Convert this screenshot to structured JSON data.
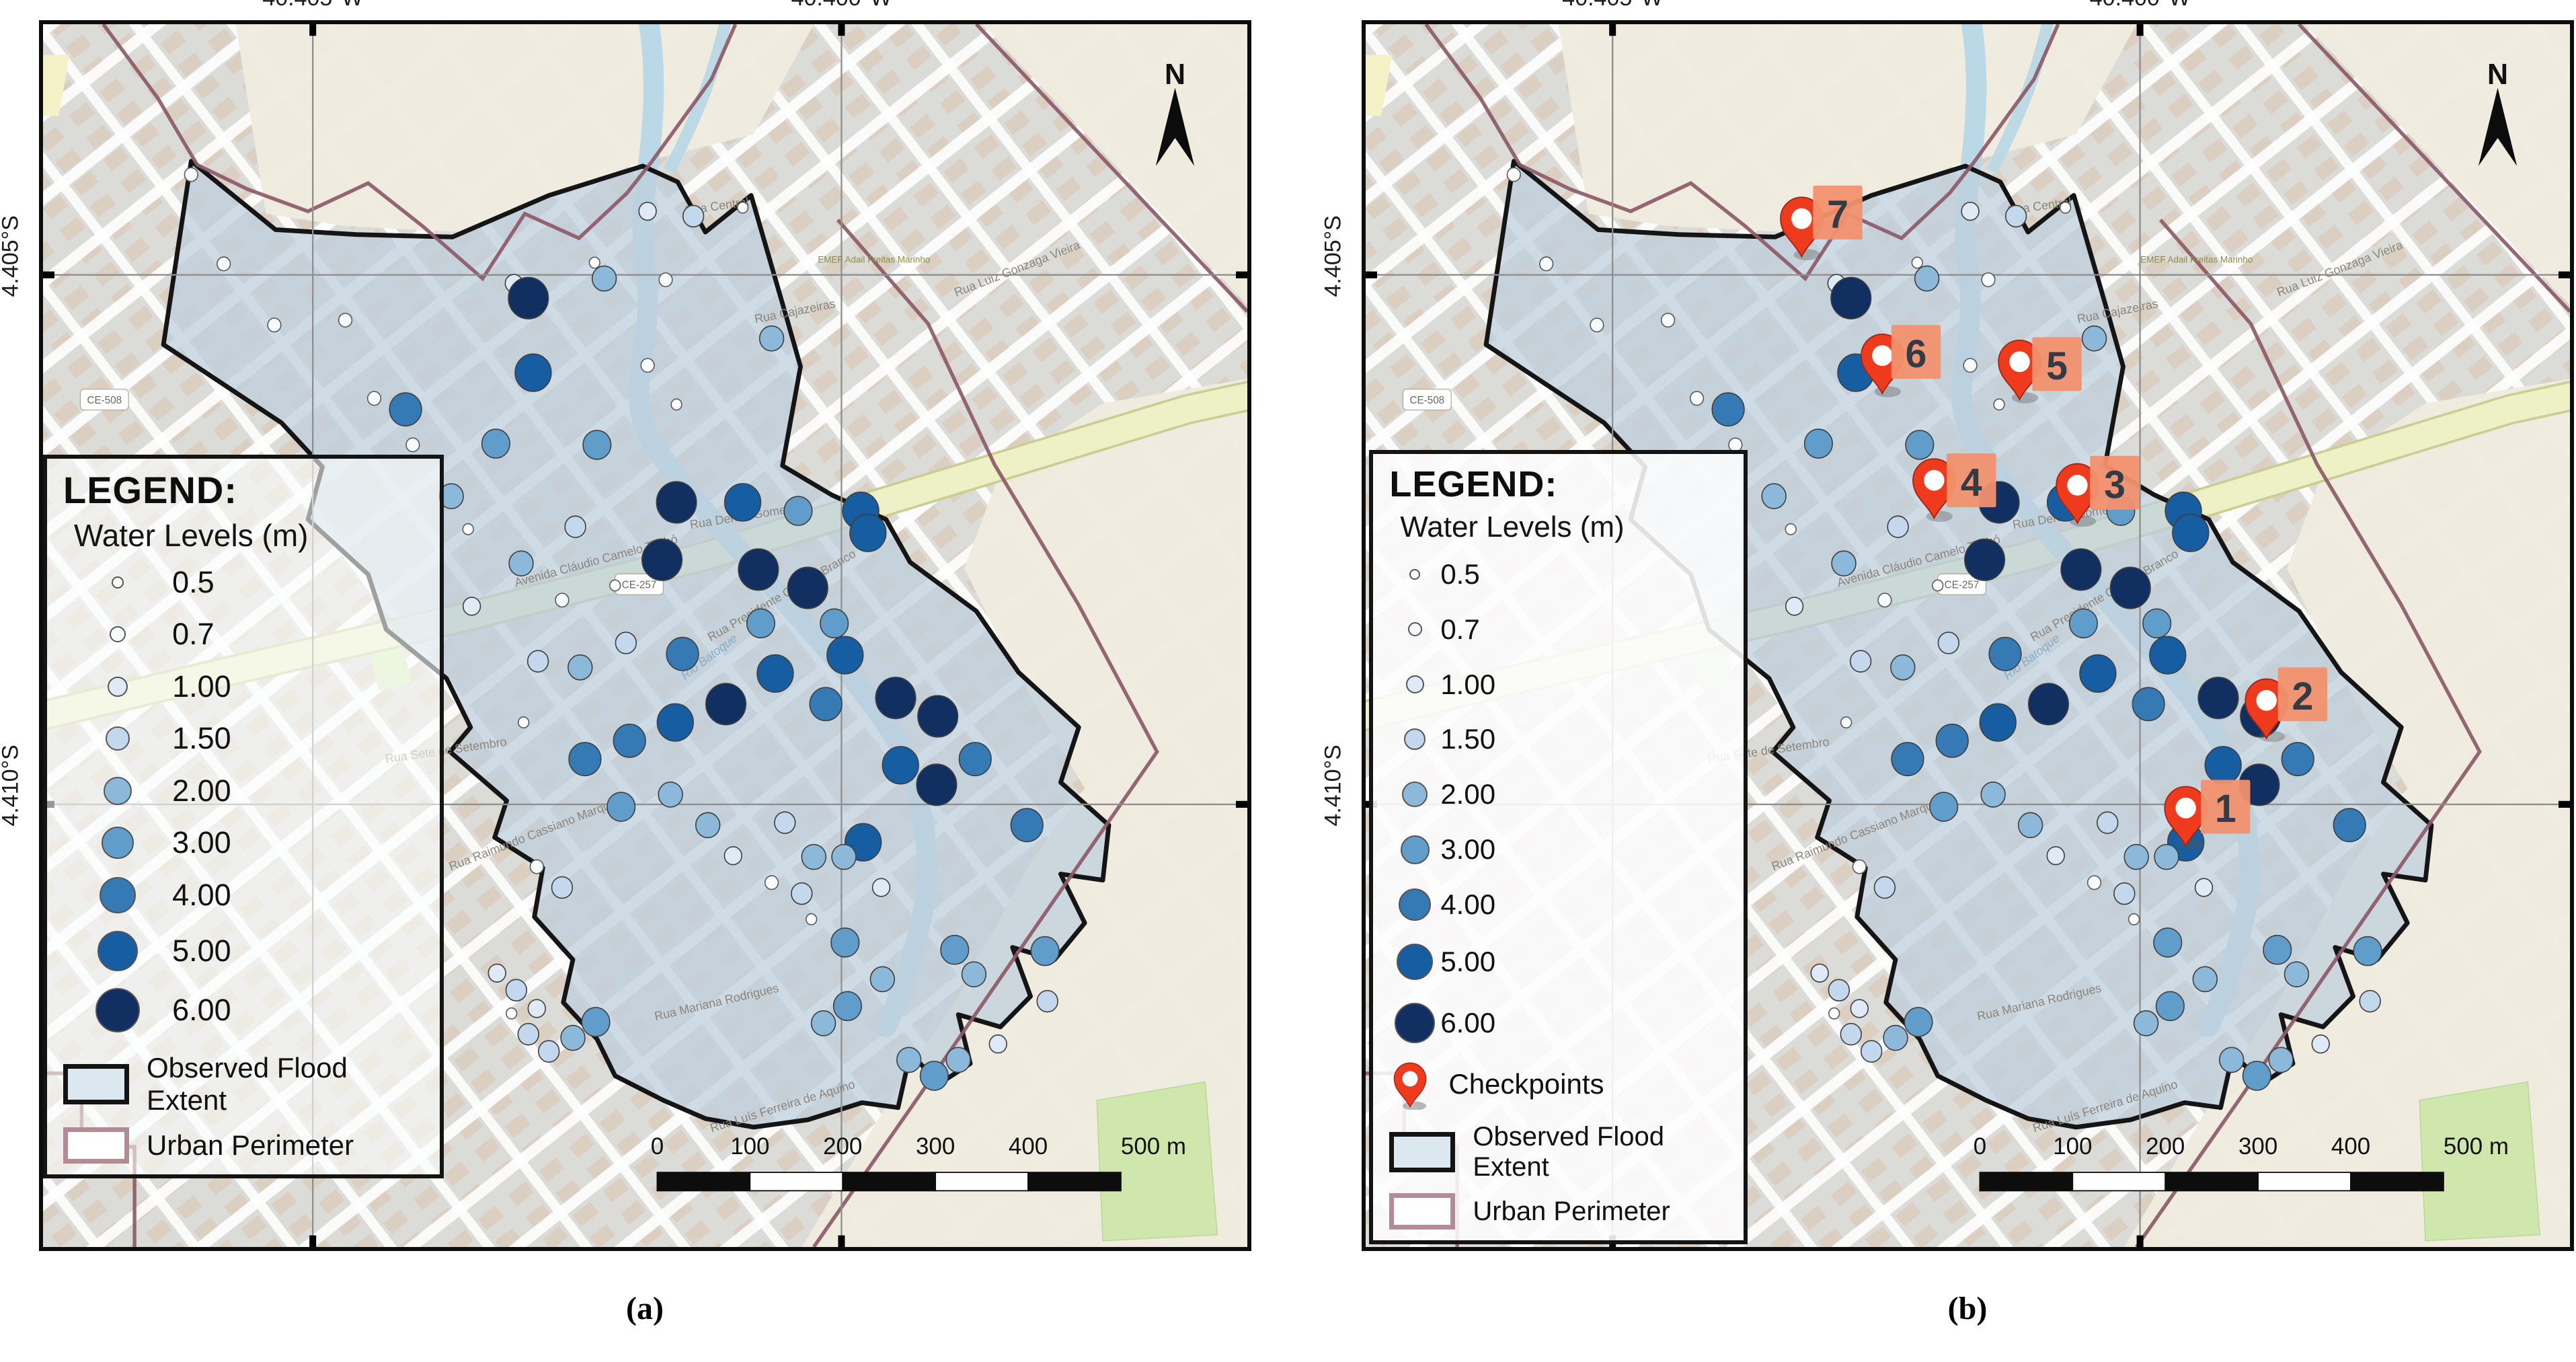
{
  "panels": {
    "a": {
      "caption": "(a)",
      "show_checkpoints": false,
      "legend_variant": "var-a",
      "grid_x_pct": [
        22.4,
        66.3
      ],
      "grid_y_pct": [
        20.5,
        63.8
      ],
      "axis_top": [
        "40.405°W",
        "40.400°W"
      ],
      "axis_left": [
        "4.405°S",
        "4.410°S"
      ]
    },
    "b": {
      "caption": "(b)",
      "show_checkpoints": true,
      "legend_variant": "var-b",
      "grid_x_pct": [
        20.5,
        64.3
      ],
      "grid_y_pct": [
        20.5,
        63.8
      ],
      "axis_top": [
        "40.405°W",
        "40.400°W"
      ],
      "axis_left": [
        "4.405°S",
        "4.410°S"
      ]
    }
  },
  "legend": {
    "title": "LEGEND:",
    "subtitle": "Water Levels (m)",
    "levels": [
      {
        "label": "0.5",
        "color": "#ffffff",
        "size_a": 18,
        "size_b": 16
      },
      {
        "label": "0.7",
        "color": "#f8fbfe",
        "size_a": 24,
        "size_b": 21
      },
      {
        "label": "1.00",
        "color": "#e0eaf6",
        "size_a": 30,
        "size_b": 27
      },
      {
        "label": "1.50",
        "color": "#c4d8ed",
        "size_a": 36,
        "size_b": 32
      },
      {
        "label": "2.00",
        "color": "#8cb9da",
        "size_a": 42,
        "size_b": 38
      },
      {
        "label": "3.00",
        "color": "#609dca",
        "size_a": 48,
        "size_b": 43
      },
      {
        "label": "4.00",
        "color": "#3579b5",
        "size_a": 54,
        "size_b": 48
      },
      {
        "label": "5.00",
        "color": "#175da1",
        "size_a": 60,
        "size_b": 54
      },
      {
        "label": "6.00",
        "color": "#112f60",
        "size_a": 66,
        "size_b": 60
      }
    ],
    "checkpoints_label": "Checkpoints",
    "flood_label": "Observed Flood Extent",
    "urban_label": "Urban Perimeter",
    "flood_swatch_color": "#dce8f0",
    "urban_swatch_border": "#b28b95"
  },
  "scalebar": {
    "labels": [
      "0",
      "100",
      "200",
      "300",
      "400",
      "500 m"
    ]
  },
  "north_label": "N",
  "map": {
    "colors": {
      "base": "#dbdbd8",
      "open_land": "#f0ebdf",
      "flood_fill": "#bccfdc",
      "flood_stroke": "#151515",
      "urban_perimeter": "#8d5a68",
      "river": "#b7d7e6",
      "avenue": "#eef0c6",
      "avenue_casing": "#cbcd92",
      "park": "#cfe7ad",
      "grid": "#8f8f8f",
      "pin_red": "#ee3b1e",
      "pin_stroke": "#a32410",
      "cp_label_bg": "#f2916e",
      "cp_label_text": "#333b44",
      "building": "#d9c7b2"
    },
    "shields": [
      {
        "text": "CE-508",
        "x": 5.1,
        "y": 30.7
      },
      {
        "text": "CE-257",
        "x": 49.5,
        "y": 45.8
      }
    ],
    "street_labels": [
      {
        "text": "Rua Central",
        "x": 56,
        "y": 15.2,
        "r": -8
      },
      {
        "text": "Rua Cajazeiras",
        "x": 62.5,
        "y": 23.8,
        "r": -11
      },
      {
        "text": "Rua Luiz Gonzaga Vieira",
        "x": 81,
        "y": 20.3,
        "r": -21
      },
      {
        "text": "Avenida Cláudio Camelo Timbó",
        "x": 46,
        "y": 44.2,
        "r": -15
      },
      {
        "text": "Rua Deniro Gomes",
        "x": 58,
        "y": 40.6,
        "r": -9
      },
      {
        "text": "Rua Presidente Castelo Branco",
        "x": 61.5,
        "y": 47,
        "r": -30
      },
      {
        "text": "Rio Batoque",
        "x": 55.5,
        "y": 52,
        "r": -37,
        "water": true
      },
      {
        "text": "Rua Sete de Setembro",
        "x": 33.5,
        "y": 59.7,
        "r": -8
      },
      {
        "text": "Rua Raimundo Cassiano Marques",
        "x": 41,
        "y": 66.5,
        "r": -21
      },
      {
        "text": "Rua Mariana Rodrigues",
        "x": 56,
        "y": 80.3,
        "r": -13
      },
      {
        "text": "Rua Luís Ferreira de Aquino",
        "x": 61.5,
        "y": 88.8,
        "r": -17
      },
      {
        "text": "EMEF Adail Freitas Marinho",
        "x": 69,
        "y": 19.5,
        "r": 0,
        "school": true
      }
    ],
    "water_level_values": [
      0.5,
      0.7,
      1.0,
      1.5,
      2.0,
      3.0,
      4.0,
      5.0,
      6.0
    ],
    "dots": [
      [
        12.3,
        12.3,
        0.7
      ],
      [
        15.0,
        19.6,
        0.7
      ],
      [
        19.2,
        24.6,
        0.7
      ],
      [
        25.1,
        24.2,
        0.7
      ],
      [
        27.5,
        30.6,
        0.7
      ],
      [
        39.1,
        21.2,
        1.0
      ],
      [
        45.8,
        19.5,
        0.5
      ],
      [
        50.2,
        15.3,
        1.0
      ],
      [
        54.0,
        15.7,
        1.5
      ],
      [
        58.1,
        15.0,
        0.5
      ],
      [
        51.7,
        20.9,
        0.7
      ],
      [
        50.2,
        27.9,
        0.7
      ],
      [
        60.5,
        25.7,
        2.0
      ],
      [
        52.6,
        31.1,
        0.5
      ],
      [
        35.3,
        41.3,
        0.5
      ],
      [
        30.7,
        34.4,
        0.7
      ],
      [
        40.3,
        22.4,
        6.0
      ],
      [
        46.6,
        20.8,
        2.0
      ],
      [
        40.7,
        28.5,
        5.0
      ],
      [
        30.1,
        31.5,
        4.0
      ],
      [
        37.6,
        34.3,
        3.0
      ],
      [
        46.0,
        34.4,
        3.0
      ],
      [
        33.9,
        38.6,
        2.0
      ],
      [
        44.2,
        41.1,
        1.5
      ],
      [
        39.7,
        44.1,
        2.0
      ],
      [
        35.6,
        47.6,
        1.0
      ],
      [
        52.6,
        39.1,
        6.0
      ],
      [
        58.1,
        39.1,
        5.0
      ],
      [
        62.7,
        39.8,
        3.0
      ],
      [
        67.9,
        39.8,
        5.0
      ],
      [
        68.5,
        41.6,
        5.0
      ],
      [
        51.4,
        43.8,
        6.0
      ],
      [
        59.6,
        49.0,
        3.0
      ],
      [
        65.7,
        49.0,
        3.0
      ],
      [
        53.1,
        51.5,
        4.0
      ],
      [
        43.1,
        47.1,
        0.7
      ],
      [
        47.5,
        45.9,
        0.5
      ],
      [
        41.1,
        52.1,
        1.5
      ],
      [
        44.6,
        52.6,
        2.0
      ],
      [
        48.4,
        50.6,
        1.5
      ],
      [
        39.9,
        57.1,
        0.5
      ],
      [
        59.4,
        44.6,
        6.0
      ],
      [
        63.5,
        46.1,
        6.0
      ],
      [
        66.6,
        51.6,
        5.0
      ],
      [
        70.8,
        55.1,
        6.0
      ],
      [
        74.3,
        56.6,
        6.0
      ],
      [
        71.2,
        60.6,
        5.0
      ],
      [
        65.0,
        55.6,
        4.0
      ],
      [
        60.8,
        53.1,
        5.0
      ],
      [
        56.7,
        55.6,
        6.0
      ],
      [
        52.5,
        57.1,
        5.0
      ],
      [
        48.7,
        58.6,
        4.0
      ],
      [
        45.0,
        60.1,
        4.0
      ],
      [
        77.4,
        60.1,
        4.0
      ],
      [
        74.2,
        62.2,
        6.0
      ],
      [
        68.1,
        66.9,
        5.0
      ],
      [
        81.7,
        65.5,
        4.0
      ],
      [
        41.0,
        68.9,
        0.7
      ],
      [
        43.1,
        70.6,
        1.5
      ],
      [
        37.7,
        77.6,
        1.0
      ],
      [
        39.3,
        79.0,
        1.5
      ],
      [
        41.0,
        80.5,
        1.0
      ],
      [
        38.9,
        80.9,
        0.5
      ],
      [
        40.3,
        82.6,
        1.5
      ],
      [
        42.0,
        84.0,
        1.5
      ],
      [
        44.0,
        82.9,
        2.0
      ],
      [
        45.9,
        81.6,
        3.0
      ],
      [
        61.6,
        65.3,
        1.5
      ],
      [
        64.0,
        68.1,
        2.0
      ],
      [
        60.5,
        70.2,
        0.7
      ],
      [
        63.0,
        71.1,
        1.5
      ],
      [
        63.8,
        73.2,
        0.5
      ],
      [
        57.3,
        68.0,
        1.0
      ],
      [
        52.1,
        63.0,
        2.0
      ],
      [
        48.0,
        64.0,
        3.0
      ],
      [
        55.2,
        65.5,
        2.0
      ],
      [
        83.2,
        75.8,
        3.0
      ],
      [
        83.4,
        79.9,
        1.5
      ],
      [
        77.3,
        77.7,
        2.0
      ],
      [
        75.7,
        75.7,
        3.0
      ],
      [
        79.3,
        83.4,
        1.0
      ],
      [
        76.0,
        84.7,
        2.0
      ],
      [
        74.0,
        86.0,
        3.0
      ],
      [
        71.9,
        84.7,
        2.0
      ],
      [
        69.7,
        78.1,
        2.0
      ],
      [
        66.6,
        75.1,
        3.0
      ],
      [
        66.8,
        80.3,
        3.0
      ],
      [
        64.8,
        81.7,
        2.0
      ],
      [
        69.6,
        70.6,
        1.0
      ],
      [
        66.5,
        68.1,
        2.0
      ]
    ],
    "checkpoints": [
      {
        "n": "1",
        "px": 68.1,
        "py": 67.2,
        "lx": 71.4,
        "ly": 64.0
      },
      {
        "n": "2",
        "px": 74.8,
        "py": 58.4,
        "lx": 77.8,
        "ly": 54.8
      },
      {
        "n": "3",
        "px": 59.1,
        "py": 40.8,
        "lx": 62.2,
        "ly": 37.5
      },
      {
        "n": "4",
        "px": 47.2,
        "py": 40.4,
        "lx": 50.3,
        "ly": 37.3
      },
      {
        "n": "5",
        "px": 54.3,
        "py": 30.7,
        "lx": 57.4,
        "ly": 27.8
      },
      {
        "n": "6",
        "px": 42.9,
        "py": 30.2,
        "lx": 45.7,
        "ly": 26.8
      },
      {
        "n": "7",
        "px": 36.2,
        "py": 19.0,
        "lx": 39.2,
        "ly": 15.4
      }
    ]
  }
}
